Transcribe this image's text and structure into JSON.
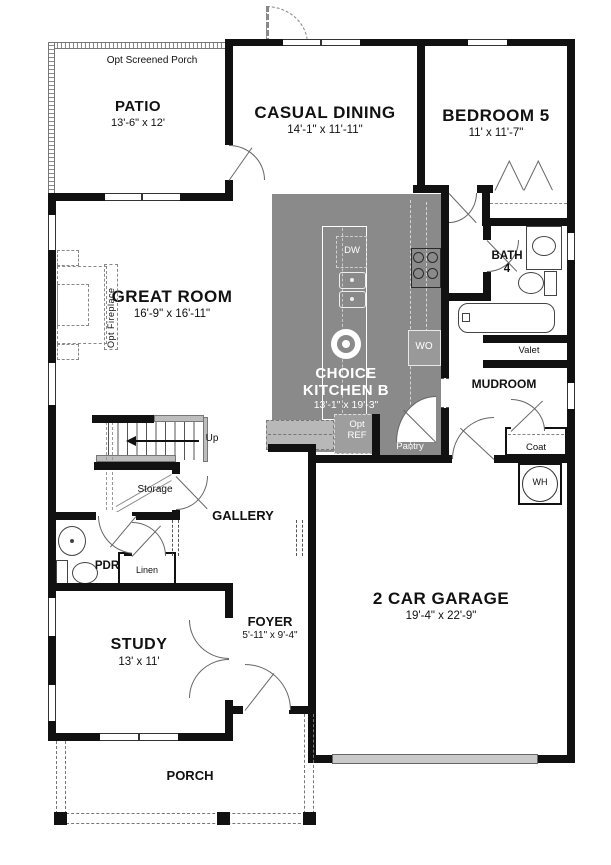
{
  "rooms": {
    "patio": {
      "name": "PATIO",
      "dims": "13'-6\" x 12'"
    },
    "casual_dining": {
      "name": "CASUAL DINING",
      "dims": "14'-1\" x 11'-11\""
    },
    "bedroom5": {
      "name": "BEDROOM 5",
      "dims": "11' x 11'-7\""
    },
    "great_room": {
      "name": "GREAT ROOM",
      "dims": "16'-9\" x 16'-11\""
    },
    "kitchen": {
      "name_line1": "CHOICE",
      "name_line2": "KITCHEN B",
      "dims": "13'-1\" x 19'-3\""
    },
    "bath4": {
      "name_line1": "BATH",
      "name_line2": "4"
    },
    "mudroom": {
      "name": "MUDROOM"
    },
    "garage": {
      "name": "2 CAR GARAGE",
      "dims": "19'-4\" x 22'-9\""
    },
    "study": {
      "name": "STUDY",
      "dims": "13' x 11'"
    },
    "foyer": {
      "name": "FOYER",
      "dims": "5'-11\" x 9'-4\""
    },
    "gallery": {
      "name": "GALLERY"
    },
    "porch": {
      "name": "PORCH"
    }
  },
  "labels": {
    "opt_screened_porch": "Opt Screened Porch",
    "opt_fireplace": "Opt Fireplace",
    "up": "Up",
    "storage": "Storage",
    "pdr": "PDR",
    "linen": "Linen",
    "valet": "Valet",
    "coat": "Coat",
    "pantry": "Pantry",
    "water_heater": "WH",
    "dishwasher": "DW",
    "wall_oven": "WO",
    "opt_ref_line1": "Opt",
    "opt_ref_line2": "REF"
  },
  "colors": {
    "wall": "#111111",
    "kitchen_fill": "#8a8a8a",
    "counter_fill": "#b8b8b8",
    "opt_ref_fill": "#9e9e9e",
    "garage_door": "#c9c9c9",
    "stair_landing": "#bdbdbd"
  }
}
